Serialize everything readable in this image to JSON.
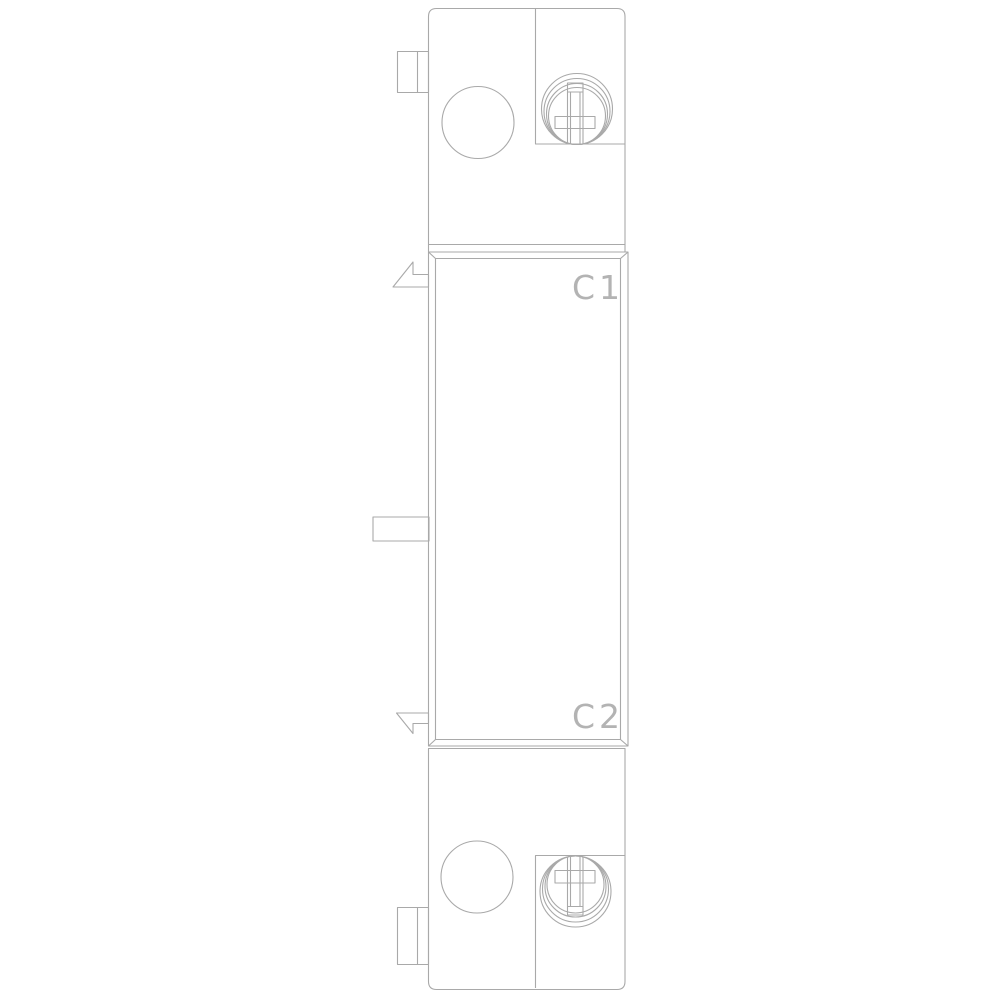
{
  "colors": {
    "line": "#a9a9a9",
    "engraved_text": "#b3b3b3",
    "background": "#ffffff"
  },
  "drawing": {
    "terminal_labels": {
      "c1": "C1",
      "c2": "C2"
    }
  }
}
